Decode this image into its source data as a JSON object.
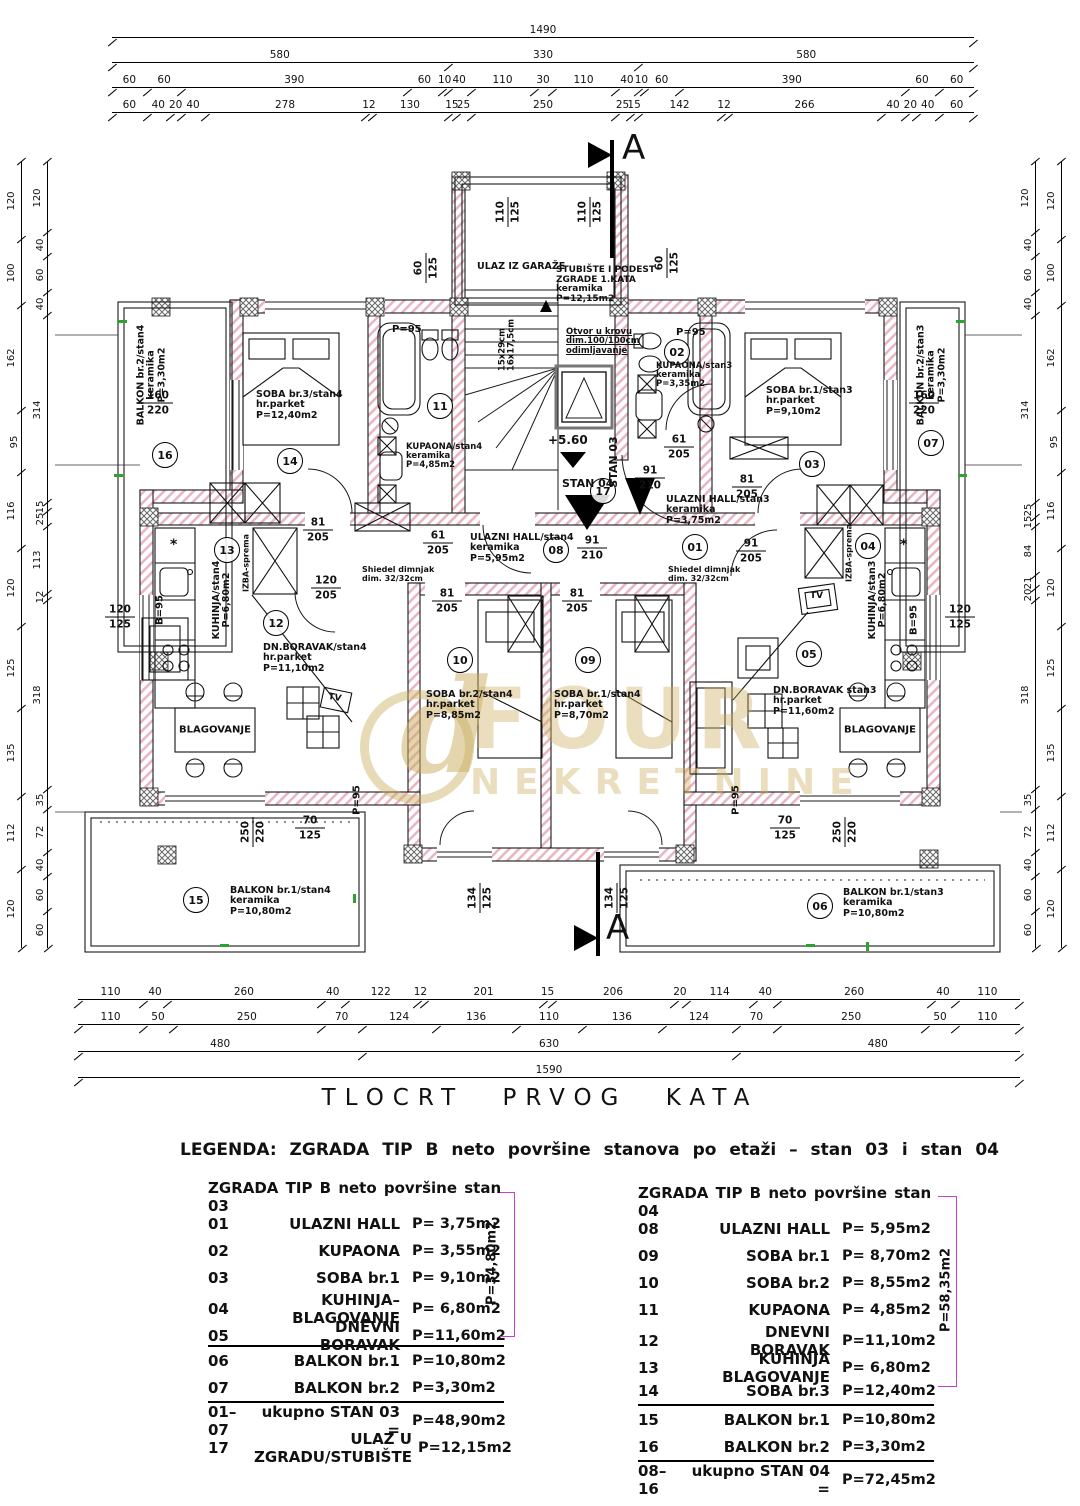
{
  "title": "TLOCRT  PRVOG  KATA",
  "watermark": {
    "big": "FOUR",
    "small": "NEKRETNINE",
    "glyph": "d"
  },
  "colors": {
    "hatch": "#e9b7c4",
    "bracket": "#cc3ecc",
    "green_mark": "#2ea12e",
    "gold": "#caac5e"
  },
  "legend": {
    "heading": "LEGENDA: ZGRADA TIP B neto površine stanova po etaži – stan 03 i stan 04",
    "stan03": {
      "header": "ZGRADA TIP B neto površine stan 03",
      "rows": [
        {
          "num": "01",
          "name": "ULAZNI HALL",
          "area": "P= 3,75m2"
        },
        {
          "num": "02",
          "name": "KUPAONA",
          "area": "P= 3,55m2"
        },
        {
          "num": "03",
          "name": "SOBA br.1",
          "area": "P= 9,10m2"
        },
        {
          "num": "04",
          "name": "KUHINJA–BLAGOVANJE",
          "area": "P= 6,80m2"
        },
        {
          "num": "05",
          "name": "DNEVNI BORAVAK",
          "area": "P=11,60m2"
        }
      ],
      "subtotal_label": "P=34,80m2",
      "balkoni": [
        {
          "num": "06",
          "name": "BALKON br.1",
          "area": "P=10,80m2"
        },
        {
          "num": "07",
          "name": "BALKON br.2",
          "area": "P=3,30m2"
        }
      ],
      "total": {
        "num": "01–07",
        "name": "ukupno STAN 03 =",
        "area": "P=48,90m2"
      },
      "extra": {
        "num": "17",
        "name": "ULAZ U ZGRADU/STUBIŠTE",
        "area": "P=12,15m2"
      }
    },
    "stan04": {
      "header": "ZGRADA TIP B neto površine stan 04",
      "rows": [
        {
          "num": "08",
          "name": "ULAZNI HALL",
          "area": "P= 5,95m2"
        },
        {
          "num": "09",
          "name": "SOBA br.1",
          "area": "P= 8,70m2"
        },
        {
          "num": "10",
          "name": "SOBA br.2",
          "area": "P= 8,55m2"
        },
        {
          "num": "11",
          "name": "KUPAONA",
          "area": "P= 4,85m2"
        },
        {
          "num": "12",
          "name": "DNEVNI BORAVAK",
          "area": "P=11,10m2"
        },
        {
          "num": "13",
          "name": "KUHINJA BLAGOVANJE",
          "area": "P= 6,80m2"
        },
        {
          "num": "14",
          "name": "SOBA br.3",
          "area": "P=12,40m2"
        }
      ],
      "subtotal_label": "P=58,35m2",
      "balkoni": [
        {
          "num": "15",
          "name": "BALKON br.1",
          "area": "P=10,80m2"
        },
        {
          "num": "16",
          "name": "BALKON br.2",
          "area": "P=3,30m2"
        }
      ],
      "total": {
        "num": "08–16",
        "name": "ukupno STAN 04 =",
        "area": "P=72,45m2"
      }
    }
  },
  "dims": {
    "top1": [
      "1490"
    ],
    "top2": [
      "580",
      "330",
      "580"
    ],
    "top3": [
      "60",
      "60",
      "390",
      "60",
      "10",
      "40",
      "110",
      "30",
      "110",
      "40",
      "10",
      "60",
      "390",
      "60",
      "60"
    ],
    "top4": [
      "60",
      "40",
      "20",
      "40",
      "278",
      "12",
      "130",
      "15",
      "25",
      "250",
      "25",
      "15",
      "142",
      "12",
      "266",
      "40",
      "20",
      "40",
      "60"
    ],
    "bottom1": [
      "110",
      "40",
      "260",
      "40",
      "122",
      "12",
      "201",
      "15",
      "206",
      "20",
      "114",
      "40",
      "260",
      "40",
      "110"
    ],
    "bottom2": [
      "110",
      "50",
      "250",
      "70",
      "124",
      "136",
      "110",
      "136",
      "124",
      "70",
      "250",
      "50",
      "110"
    ],
    "bottom3": [
      "480",
      "630",
      "480"
    ],
    "bottom4": [
      "1590"
    ],
    "left_outer": [
      "120",
      "100",
      "162",
      "95",
      "116",
      "120",
      "125",
      "135",
      "112",
      "120"
    ],
    "left_inner": [
      "120",
      "40",
      "60",
      "40",
      "314",
      "15",
      "25",
      "113",
      "12",
      "318",
      "35",
      "72",
      "40",
      "60",
      "60"
    ],
    "right_inner": [
      "120",
      "40",
      "60",
      "40",
      "314",
      "25",
      "15",
      "84",
      "21",
      "20",
      "318",
      "35",
      "72",
      "40",
      "60",
      "60"
    ],
    "right_outer": [
      "120",
      "100",
      "162",
      "95",
      "116",
      "120",
      "125",
      "135",
      "112",
      "120"
    ]
  },
  "plan": {
    "section_label": "A",
    "level_label": "+5.60",
    "stan03_label": "STAN 03",
    "stan04_label": "STAN 04",
    "rooms": [
      {
        "num": "16",
        "label": "BALKON br.2/stan4\nkeramika\nP=3,30m2"
      },
      {
        "num": "14",
        "label": "SOBA br.3/stan4\nhr.parket\nP=12,40m2"
      },
      {
        "num": "11",
        "label": "KUPAONA/stan4\nkeramika\nP=4,85m2"
      },
      {
        "num": "13",
        "label": "KUHINJA/stan4\nP=6,80m2"
      },
      {
        "num": "12",
        "label": "DN.BORAVAK/stan4\nhr.parket\nP=11,10m2"
      },
      {
        "num": "10",
        "label": "SOBA br.2/stan4\nhr.parket\nP=8,85m2"
      },
      {
        "num": "09",
        "label": "SOBA br.1/stan4\nhr.parket\nP=8,70m2"
      },
      {
        "num": "08",
        "label": "ULAZNI HALL/stan4\nkeramika\nP=5,95m2"
      },
      {
        "num": "17",
        "label": "STUBIŠTE I PODEST\nZGRADE 1.KATA\nkeramika\nP=12,15m2"
      },
      {
        "num": "15",
        "label": "BALKON br.1/stan4\nkeramika\nP=10,80m2"
      },
      {
        "num": "01",
        "label": "ULAZNI HALL/stan3\nkeramika\nP=3,75m2"
      },
      {
        "num": "02",
        "label": "KUPAONA/stan3\nkeramika\nP=3,35m2"
      },
      {
        "num": "03",
        "label": "SOBA br.1/stan3\nhr.parket\nP=9,10m2"
      },
      {
        "num": "04",
        "label": "KUHINJA/stan3\nP=6,80m2"
      },
      {
        "num": "05",
        "label": "DN.BORAVAK stan3\nhr.parket\nP=11,60m2"
      },
      {
        "num": "06",
        "label": "BALKON br.1/stan3\nkeramika\nP=10,80m2"
      },
      {
        "num": "07",
        "label": "BALKON br.2/stan3\nkeramika\nP=3,30m2"
      }
    ],
    "labels": {
      "ulaz_garaze": "ULAZ IZ GARAŽE",
      "otvor": "Otvor u krovu\ndim.100/100cm\nodimljavanje",
      "dimnjak": "Shiedel dimnjak\ndim. 32/32cm",
      "stair_steps": "15x29cm\n16x17,5cm",
      "blagovanje": "BLAGOVANJE",
      "izba": "IZBA-sprema",
      "tv": "TV",
      "p95": "P=95",
      "b95": "B=95",
      "star": "*"
    },
    "fractions": [
      {
        "a": "160",
        "b": "220"
      },
      {
        "a": "160",
        "b": "220"
      },
      {
        "a": "81",
        "b": "205"
      },
      {
        "a": "81",
        "b": "205"
      },
      {
        "a": "81",
        "b": "205"
      },
      {
        "a": "81",
        "b": "205"
      },
      {
        "a": "61",
        "b": "205"
      },
      {
        "a": "61",
        "b": "205"
      },
      {
        "a": "91",
        "b": "210"
      },
      {
        "a": "91",
        "b": "210"
      },
      {
        "a": "91",
        "b": "205"
      },
      {
        "a": "120",
        "b": "205"
      },
      {
        "a": "120",
        "b": "125"
      },
      {
        "a": "120",
        "b": "125"
      },
      {
        "a": "70",
        "b": "125"
      },
      {
        "a": "70",
        "b": "125"
      },
      {
        "a": "250",
        "b": "220"
      },
      {
        "a": "250",
        "b": "220"
      },
      {
        "a": "134",
        "b": "125"
      },
      {
        "a": "134",
        "b": "125"
      },
      {
        "a": "110",
        "b": "125"
      },
      {
        "a": "110",
        "b": "125"
      },
      {
        "a": "60",
        "b": "125"
      },
      {
        "a": "60",
        "b": "125"
      }
    ]
  }
}
